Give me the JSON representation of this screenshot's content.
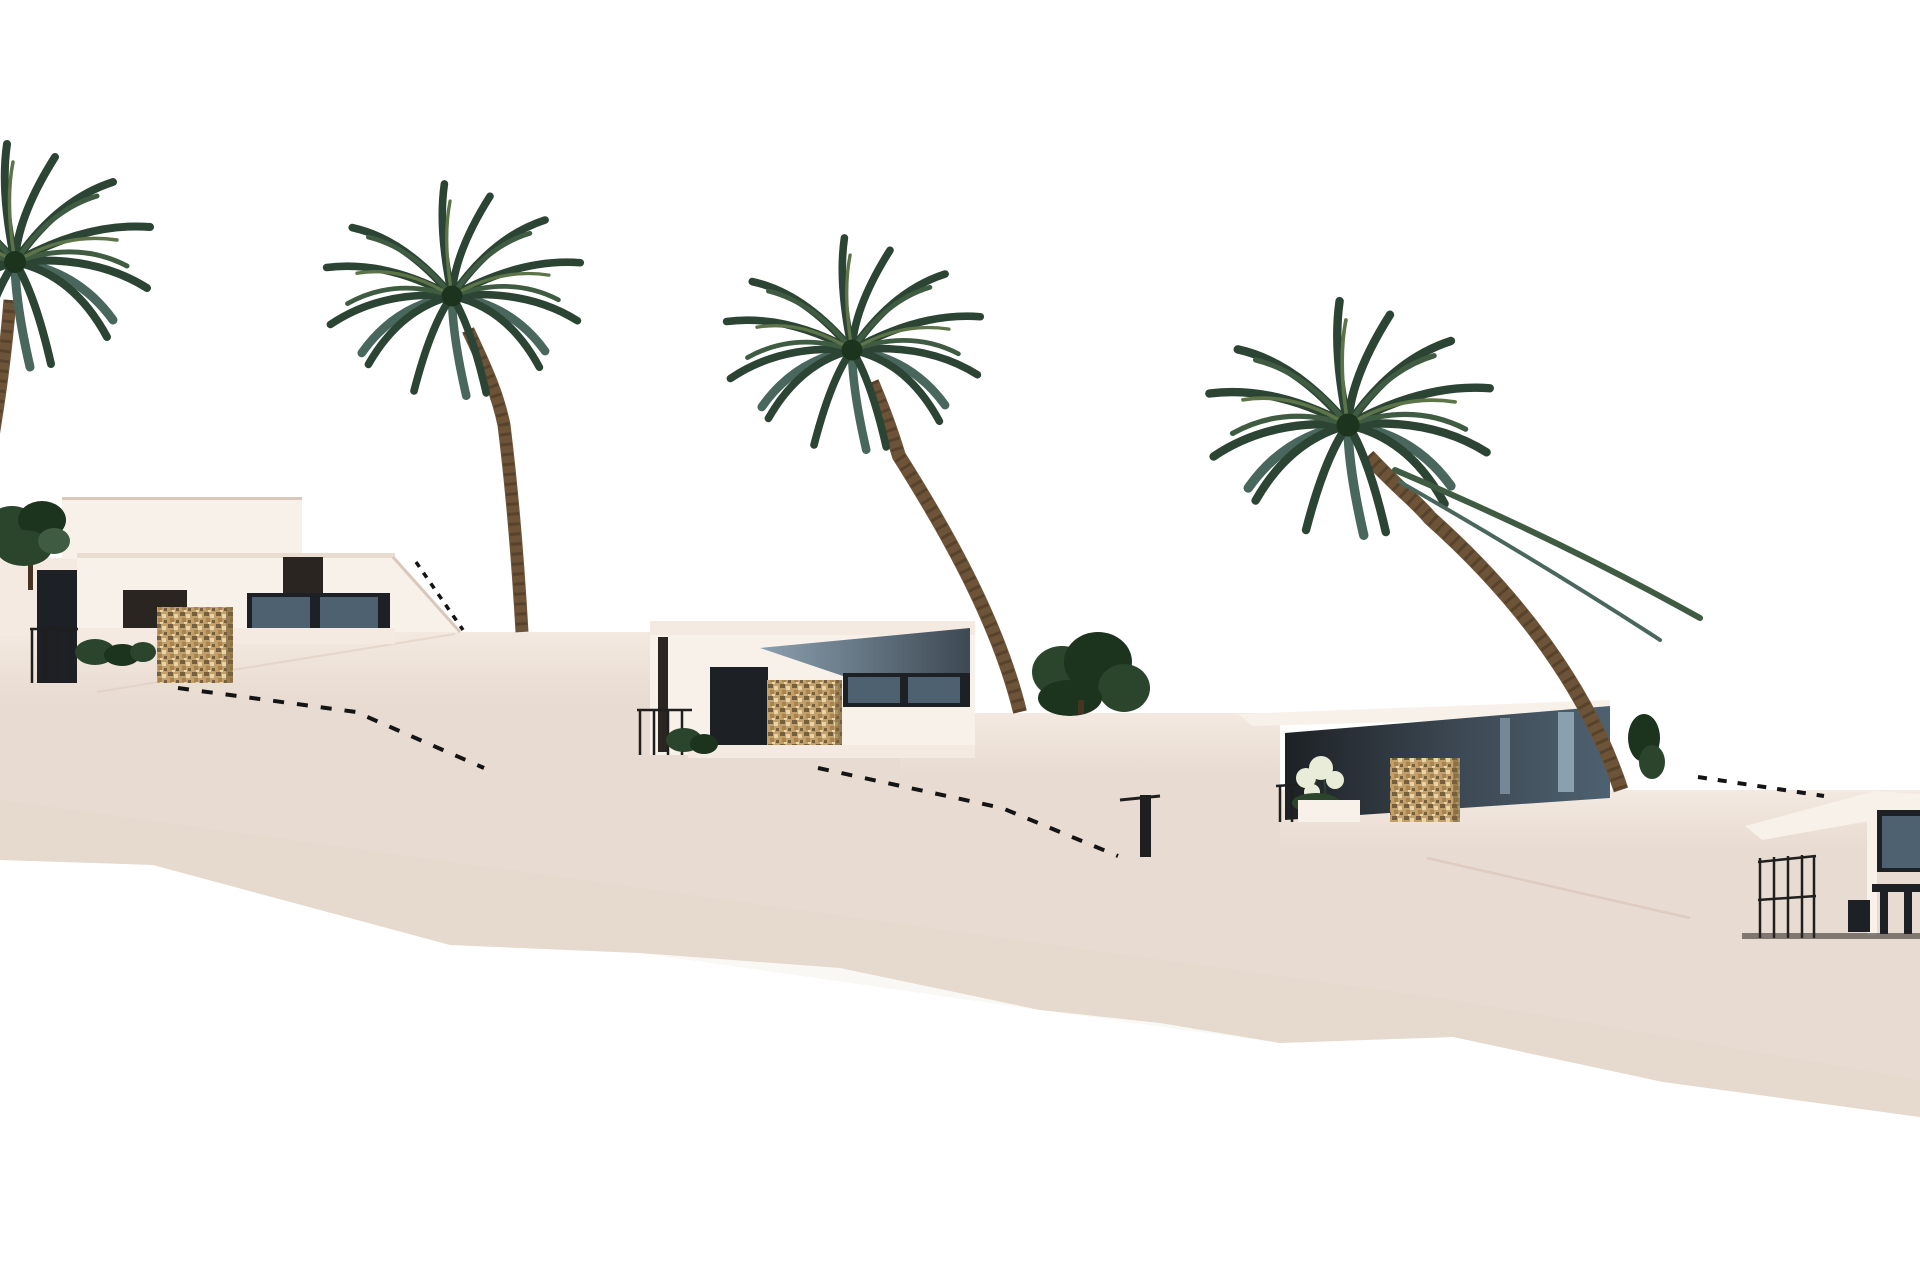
{
  "image_type": "3d-architectural-render",
  "description": "Exterior render of a hillside development of modern flat-roofed white villas with travertine stone accent pillars, stepping down a pale beige terraced slope from left to right, with four tall palm trees, low shrubs and dashed stair railings between terraces, all on a pure white sky background. No text, UI elements or labels are present.",
  "colors": {
    "sky": "#ffffff",
    "terrain": "#e8dbd1",
    "terrain_shade": "#dccaba",
    "wall_light": "#f4eae1",
    "villa_white": "#f7f1ea",
    "villa_shade": "#e9dcd1",
    "roof_edge": "#d9c8ba",
    "dark_window": "#1d2125",
    "glass_blue": "#4e6170",
    "glass_light": "#8ba0af",
    "dark_roof": "#3d4954",
    "dark_brown": "#2b2522",
    "stone_base": "#c29f6b",
    "stone_mid": "#a8854f",
    "stone_dark": "#74603c",
    "stone_light": "#e8d4a6",
    "palm_green_dark": "#2c4434",
    "palm_green_mid": "#3f5c42",
    "palm_green_light": "#5d7348",
    "palm_teal": "#49675c",
    "trunk_brown": "#6d5438",
    "trunk_dark": "#463322",
    "shrub_green": "#2a452b",
    "shrub_dark": "#1c331e",
    "flower_pale": "#e9ecd8",
    "railing_dark": "#1f1f1f",
    "dash_line": "#141414"
  },
  "scene": {
    "sky": {
      "label": "empty white sky"
    },
    "terrain": {
      "label": "terraced beige hillside stepping down from left to right with white retaining walls",
      "tier_wall_top_y": [
        632,
        713,
        790
      ],
      "stair_railing_count": 4
    },
    "palm_trees": [
      {
        "label": "tall palm tree at far left edge, crown partially cropped"
      },
      {
        "label": "tall palm tree left of center standing on upper terrace wall"
      },
      {
        "label": "tall palm tree center with trunk leaning right down to mid terrace"
      },
      {
        "label": "tall palm tree right with long trunk leaning down to lower terrace"
      }
    ],
    "villas": [
      {
        "label": "villa 1, upper left terrace",
        "features": [
          "flat white roof volumes",
          "dark glazing band",
          "dark entry opening",
          "travertine stone pillar",
          "black railing",
          "low shrubs",
          "round green tree"
        ]
      },
      {
        "label": "villa 2, second terrace",
        "features": [
          "white walls",
          "angled dark roof plane",
          "dark window wall",
          "travertine stone pillar",
          "black railing",
          "small shrub"
        ]
      },
      {
        "label": "villa 3, third terrace",
        "features": [
          "white fascia roof band",
          "dark blue-grey glazed facade",
          "travertine stone pillar",
          "white planter with pale flowers",
          "black railing"
        ]
      },
      {
        "label": "villa 4, lower right edge, partially cropped",
        "features": [
          "white sloped fascia",
          "dark glazing",
          "black railing with outdoor furniture silhouette"
        ]
      }
    ],
    "vegetation": [
      {
        "label": "round dark green tree at far left"
      },
      {
        "label": "shrub row in front of villa 1"
      },
      {
        "label": "small shrub at villa 2 base"
      },
      {
        "label": "bush cluster at center palm trunk base"
      },
      {
        "label": "pale flowering plant in villa 3 planter"
      },
      {
        "label": "dark fronds at right palm trunk base"
      }
    ]
  }
}
